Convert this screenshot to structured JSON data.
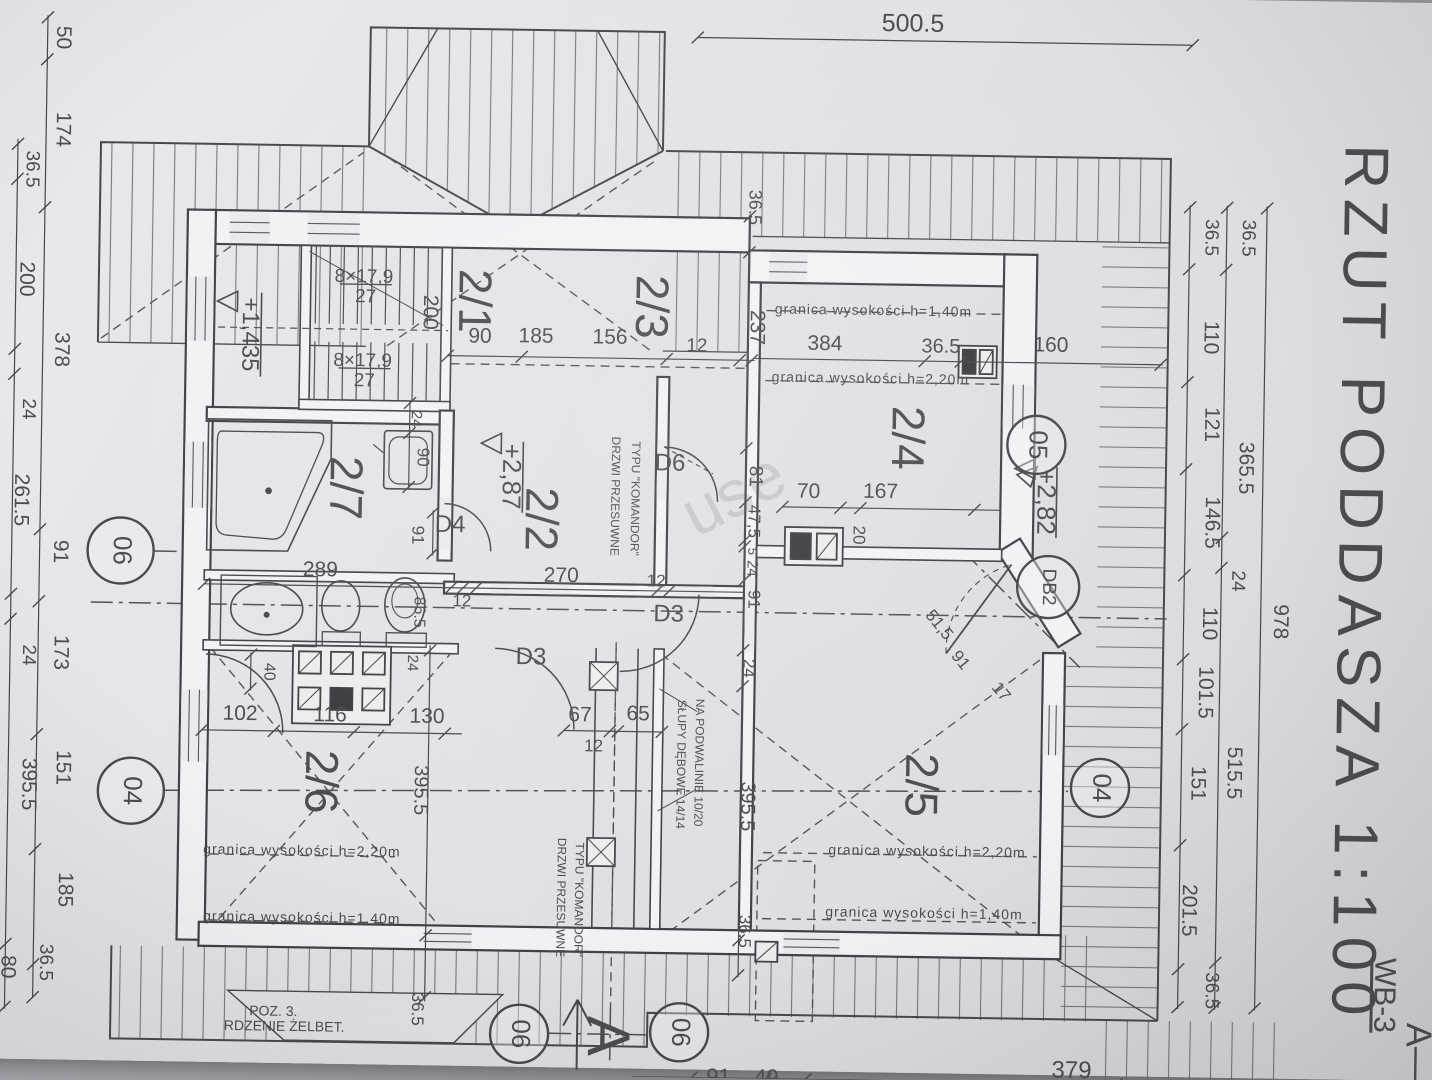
{
  "title_block": {
    "title": "RZUT PODDASZA 1:100",
    "drawing_code": "WB-3",
    "section_mark": "A—"
  },
  "rooms": [
    "2/1",
    "2/2",
    "2/3",
    "2/4",
    "2/5",
    "2/6",
    "2/7"
  ],
  "colors": {
    "paper": "#e2e3e7",
    "ink": "#47484d",
    "hatch": "#63646b",
    "backdrop": "#9a9ba1"
  },
  "watermark": {
    "t": "use",
    "x": 735,
    "y": 498,
    "r": -28,
    "s": 66,
    "o": 0.16,
    "c": "#7c828c"
  },
  "labels": [
    {
      "n": "sheet-title",
      "t": "RZUT PODDASZA 1:100",
      "x": 1356,
      "y": 575,
      "r": 90,
      "s": 62,
      "ls": 10,
      "c": "#85868d"
    },
    {
      "n": "drawing-code",
      "t": "WB-3",
      "x": 1390,
      "y": 985,
      "r": 90,
      "s": 30,
      "u": true
    },
    {
      "n": "section-letter",
      "t": "A—",
      "x": 1424,
      "y": 1042,
      "r": 90,
      "s": 36
    },
    {
      "n": "section-arrow-letter",
      "t": "A",
      "x": 612,
      "y": 1038,
      "r": 90,
      "s": 60
    },
    {
      "t": "500.5",
      "x": 905,
      "y": 22,
      "s": 25
    },
    {
      "t": "50",
      "x": 55,
      "y": 48,
      "r": 90
    },
    {
      "t": "174",
      "x": 56,
      "y": 140,
      "r": 90
    },
    {
      "t": "378",
      "x": 58,
      "y": 360,
      "r": 90
    },
    {
      "t": "91",
      "x": 60,
      "y": 562,
      "r": 90
    },
    {
      "t": "173",
      "x": 62,
      "y": 663,
      "r": 90
    },
    {
      "t": "151",
      "x": 66,
      "y": 778,
      "r": 90
    },
    {
      "t": "185",
      "x": 70,
      "y": 900,
      "r": 90
    },
    {
      "t": "36.5",
      "x": 52,
      "y": 973,
      "r": 90,
      "s": 19
    },
    {
      "t": "36.5",
      "x": 26,
      "y": 180,
      "r": 90,
      "s": 19
    },
    {
      "t": "200",
      "x": 22,
      "y": 290,
      "r": 90
    },
    {
      "t": "24",
      "x": 26,
      "y": 420,
      "r": 90,
      "s": 19
    },
    {
      "t": "261.5",
      "x": 20,
      "y": 511,
      "r": 90
    },
    {
      "t": "24",
      "x": 30,
      "y": 666,
      "r": 90,
      "s": 19
    },
    {
      "t": "395.5",
      "x": 32,
      "y": 795,
      "r": 90
    },
    {
      "t": "80",
      "x": 14,
      "y": 978,
      "r": 90
    },
    {
      "t": "36.5",
      "x": 1206,
      "y": 230,
      "r": 90,
      "s": 19
    },
    {
      "t": "110",
      "x": 1207,
      "y": 330,
      "r": 90
    },
    {
      "t": "121",
      "x": 1209,
      "y": 417,
      "r": 90
    },
    {
      "t": "146.5",
      "x": 1211,
      "y": 515,
      "r": 90
    },
    {
      "t": "110",
      "x": 1210,
      "y": 616,
      "r": 90
    },
    {
      "t": "101.5",
      "x": 1207,
      "y": 685,
      "r": 90
    },
    {
      "t": "151",
      "x": 1201,
      "y": 776,
      "r": 90
    },
    {
      "t": "201.5",
      "x": 1194,
      "y": 903,
      "r": 90
    },
    {
      "t": "36.5",
      "x": 1218,
      "y": 983,
      "r": 90,
      "s": 19
    },
    {
      "t": "36.5",
      "x": 1243,
      "y": 230,
      "r": 90,
      "s": 19
    },
    {
      "t": "365.5",
      "x": 1244,
      "y": 460,
      "r": 90
    },
    {
      "t": "24",
      "x": 1238,
      "y": 573,
      "r": 90,
      "s": 19
    },
    {
      "t": "515.5",
      "x": 1237,
      "y": 765,
      "r": 90
    },
    {
      "t": "978",
      "x": 1281,
      "y": 613,
      "r": 90
    },
    {
      "t": "379",
      "x": 1080,
      "y": 1066,
      "s": 24
    },
    {
      "t": "91",
      "x": 727,
      "y": 1078,
      "s": 22
    },
    {
      "t": "49",
      "x": 775,
      "y": 1078,
      "s": 22
    },
    {
      "n": "room-label",
      "t": "2/1",
      "x": 468,
      "y": 305,
      "r": 90,
      "s": 46
    },
    {
      "n": "room-label",
      "t": "2/3",
      "x": 645,
      "y": 308,
      "r": 90,
      "s": 46
    },
    {
      "n": "room-label",
      "t": "2/2",
      "x": 538,
      "y": 522,
      "r": 90,
      "s": 46
    },
    {
      "n": "room-label",
      "t": "2/4",
      "x": 903,
      "y": 435,
      "r": 90,
      "s": 46
    },
    {
      "n": "room-label",
      "t": "2/7",
      "x": 342,
      "y": 494,
      "r": 90,
      "s": 46
    },
    {
      "n": "room-label",
      "t": "2/6",
      "x": 322,
      "y": 788,
      "r": 90,
      "s": 46
    },
    {
      "n": "room-label",
      "t": "2/5",
      "x": 922,
      "y": 782,
      "r": 90,
      "s": 46
    },
    {
      "n": "stair-note",
      "t": "8×17,9",
      "x": 360,
      "y": 283,
      "s": 19
    },
    {
      "n": "stair-note",
      "t": "27",
      "x": 362,
      "y": 303,
      "s": 19
    },
    {
      "n": "stair-note",
      "t": "8×17,9",
      "x": 360,
      "y": 367,
      "s": 19
    },
    {
      "n": "stair-note",
      "t": "27",
      "x": 362,
      "y": 387,
      "s": 19
    },
    {
      "n": "level-mark",
      "t": "+1,435",
      "x": 246,
      "y": 342,
      "r": 90,
      "s": 24
    },
    {
      "n": "level-mark",
      "t": "+2,87",
      "x": 509,
      "y": 480,
      "r": 90,
      "s": 26
    },
    {
      "n": "level-mark",
      "t": "+2,82",
      "x": 1044,
      "y": 497,
      "r": 90,
      "s": 26
    },
    {
      "t": "200",
      "x": 426,
      "y": 317,
      "r": 90
    },
    {
      "t": "90",
      "x": 477,
      "y": 341
    },
    {
      "t": "185",
      "x": 533,
      "y": 340
    },
    {
      "t": "156",
      "x": 607,
      "y": 340
    },
    {
      "t": "12",
      "x": 694,
      "y": 347,
      "s": 19
    },
    {
      "t": "384",
      "x": 822,
      "y": 343
    },
    {
      "t": "36.5",
      "x": 938,
      "y": 344,
      "s": 20
    },
    {
      "t": "160",
      "x": 1048,
      "y": 341
    },
    {
      "t": "237",
      "x": 753,
      "y": 327,
      "r": 90,
      "s": 21
    },
    {
      "t": "36.5",
      "x": 749,
      "y": 207,
      "r": 90,
      "s": 18
    },
    {
      "n": "height-limit",
      "t": "granica wysokości h=1,40m",
      "x": 870,
      "y": 309,
      "s": 14,
      "ls": 1
    },
    {
      "n": "height-limit",
      "t": "granica wysokości h=2,20m",
      "x": 868,
      "y": 377,
      "s": 14,
      "ls": 1
    },
    {
      "t": "70",
      "x": 808,
      "y": 491,
      "s": 21
    },
    {
      "t": "20",
      "x": 858,
      "y": 533,
      "r": 90,
      "s": 17
    },
    {
      "t": "167",
      "x": 880,
      "y": 490,
      "s": 21
    },
    {
      "t": "81",
      "x": 754,
      "y": 476,
      "r": 90,
      "s": 19
    },
    {
      "t": "47,5",
      "x": 753,
      "y": 521,
      "r": 90,
      "s": 17
    },
    {
      "t": "5",
      "x": 752,
      "y": 551,
      "r": 90,
      "s": 13
    },
    {
      "t": "24",
      "x": 752,
      "y": 568,
      "r": 90,
      "s": 15
    },
    {
      "t": "91",
      "x": 754,
      "y": 599,
      "r": 90,
      "s": 17
    },
    {
      "t": "24",
      "x": 750,
      "y": 668,
      "r": 90,
      "s": 17
    },
    {
      "t": "395.5",
      "x": 751,
      "y": 806,
      "r": 90,
      "s": 20
    },
    {
      "t": "36.5",
      "x": 750,
      "y": 931,
      "r": 90,
      "s": 17
    },
    {
      "n": "door-label",
      "t": "D6",
      "x": 669,
      "y": 465,
      "s": 24
    },
    {
      "n": "door-note",
      "t": "DRZWI PRZESUWNE",
      "x": 614,
      "y": 498,
      "r": 90,
      "s": 12
    },
    {
      "n": "door-note",
      "t": "TYPU \"KOMANDOR\"",
      "x": 634,
      "y": 500,
      "r": 90,
      "s": 12
    },
    {
      "n": "door-label",
      "t": "D3",
      "x": 670,
      "y": 616,
      "s": 24
    },
    {
      "n": "door-label",
      "t": "D3",
      "x": 533,
      "y": 661,
      "s": 24
    },
    {
      "n": "door-label",
      "t": "D4",
      "x": 450,
      "y": 530,
      "s": 24
    },
    {
      "t": "270",
      "x": 562,
      "y": 579,
      "s": 21
    },
    {
      "t": "12",
      "x": 657,
      "y": 583,
      "s": 17
    },
    {
      "t": "12",
      "x": 463,
      "y": 606,
      "s": 17
    },
    {
      "t": "86.5",
      "x": 420,
      "y": 617,
      "r": 90,
      "s": 16
    },
    {
      "t": "289",
      "x": 321,
      "y": 577,
      "s": 21
    },
    {
      "t": "40",
      "x": 271,
      "y": 679,
      "r": 90,
      "s": 16
    },
    {
      "t": "24",
      "x": 414,
      "y": 668,
      "r": 90,
      "s": 15
    },
    {
      "t": "102",
      "x": 243,
      "y": 722,
      "s": 21
    },
    {
      "t": "116",
      "x": 333,
      "y": 722,
      "s": 21
    },
    {
      "t": "130",
      "x": 430,
      "y": 722,
      "s": 21
    },
    {
      "t": "91",
      "x": 417,
      "y": 540,
      "r": 90,
      "s": 17
    },
    {
      "t": "24",
      "x": 414,
      "y": 424,
      "r": 90,
      "s": 15
    },
    {
      "t": "90",
      "x": 421,
      "y": 462,
      "r": 90,
      "s": 17
    },
    {
      "t": "65",
      "x": 641,
      "y": 716,
      "s": 21
    },
    {
      "t": "67",
      "x": 583,
      "y": 718,
      "s": 21
    },
    {
      "t": "12",
      "x": 597,
      "y": 749,
      "s": 17
    },
    {
      "n": "post-note",
      "t": "SŁUPY DĘBOWE 14/14",
      "x": 684,
      "y": 765,
      "r": 90,
      "s": 12
    },
    {
      "n": "post-note",
      "t": "NA PODWALINIE 10/20",
      "x": 702,
      "y": 763,
      "r": 90,
      "s": 12
    },
    {
      "n": "door-note",
      "t": "DRZWI PRZESUWNE",
      "x": 566,
      "y": 900,
      "r": 90,
      "s": 12
    },
    {
      "n": "door-note",
      "t": "TYPU \"KOMANDOR\"",
      "x": 584,
      "y": 902,
      "r": 90,
      "s": 12
    },
    {
      "n": "height-limit",
      "t": "granica wysokości h=2,20m",
      "x": 307,
      "y": 858,
      "s": 14,
      "ls": 1
    },
    {
      "n": "height-limit",
      "t": "granica wysokości h=1,40m",
      "x": 308,
      "y": 925,
      "s": 14,
      "ls": 1
    },
    {
      "n": "height-limit",
      "t": "granica wysokości h=2,20m",
      "x": 932,
      "y": 849,
      "s": 14,
      "ls": 1
    },
    {
      "n": "height-limit",
      "t": "granica wysokości h=1,40m",
      "x": 930,
      "y": 911,
      "s": 14,
      "ls": 1
    },
    {
      "n": "core-note",
      "t": "POZ. 3.",
      "x": 281,
      "y": 1019,
      "s": 14
    },
    {
      "n": "core-note",
      "t": "RDZENIE ŻELBET.",
      "x": 292,
      "y": 1034,
      "s": 14
    },
    {
      "t": "51,5",
      "x": 940,
      "y": 622,
      "r": 50,
      "s": 17
    },
    {
      "t": "91",
      "x": 962,
      "y": 657,
      "r": 50,
      "s": 17
    },
    {
      "t": "17",
      "x": 1003,
      "y": 688,
      "r": 50,
      "s": 17
    },
    {
      "t": "395.5",
      "x": 424,
      "y": 795,
      "r": 90,
      "s": 20
    },
    {
      "t": "36.5",
      "x": 424,
      "y": 1014,
      "r": 90,
      "s": 17
    }
  ],
  "section_marks": [
    {
      "t": "06",
      "x": 121,
      "y": 560,
      "r": 33
    },
    {
      "t": "04",
      "x": 135,
      "y": 800,
      "r": 33
    },
    {
      "t": "05",
      "x": 1035,
      "y": 440,
      "r": 29
    },
    {
      "t": "DB2",
      "x": 1049,
      "y": 582,
      "r": 31
    },
    {
      "t": "04",
      "x": 1104,
      "y": 782,
      "r": 29
    },
    {
      "t": "06",
      "x": 527,
      "y": 1037,
      "r": 29
    },
    {
      "t": "06",
      "x": 687,
      "y": 1033,
      "r": 29
    }
  ],
  "dim_chains": [
    {
      "o": "h",
      "pos": 38,
      "from": 690,
      "to": 1185,
      "ticks": [
        690,
        1185
      ]
    },
    {
      "o": "v",
      "pos": 40,
      "from": 26,
      "to": 1008,
      "ticks": [
        28,
        70,
        218,
        540,
        612,
        745,
        860,
        975,
        1008
      ]
    },
    {
      "o": "v",
      "pos": 12,
      "from": 150,
      "to": 1020,
      "ticks": [
        155,
        190,
        360,
        385,
        605,
        630,
        955,
        1018
      ]
    },
    {
      "o": "v",
      "pos": 1185,
      "from": 198,
      "to": 1002,
      "ticks": [
        200,
        262,
        375,
        462,
        568,
        652,
        722,
        838,
        962,
        1000
      ]
    },
    {
      "o": "v",
      "pos": 1222,
      "from": 198,
      "to": 1002,
      "ticks": [
        200,
        262,
        530,
        560,
        955,
        1000
      ]
    },
    {
      "o": "v",
      "pos": 1262,
      "from": 198,
      "to": 1002,
      "ticks": [
        200,
        1000
      ]
    },
    {
      "o": "h",
      "pos": 1078,
      "from": 640,
      "to": 1310,
      "ticks": [
        700,
        774,
        814,
        1125
      ]
    },
    {
      "o": "h",
      "pos": 360,
      "from": 445,
      "to": 752,
      "ticks": [
        445,
        519,
        664,
        737,
        749
      ]
    },
    {
      "o": "h",
      "pos": 358,
      "from": 752,
      "to": 1160,
      "ticks": [
        922,
        958,
        1158
      ]
    },
    {
      "o": "v",
      "pos": 745,
      "from": 214,
      "to": 977,
      "ticks": [
        216,
        252,
        448,
        502,
        540,
        546,
        580,
        650,
        686,
        940,
        975
      ]
    },
    {
      "o": "h",
      "pos": 592,
      "from": 205,
      "to": 745,
      "ticks": [
        205,
        452,
        464,
        477,
        658,
        670
      ]
    },
    {
      "o": "h",
      "pos": 738,
      "from": 205,
      "to": 465,
      "ticks": [
        205,
        277,
        357,
        448
      ]
    },
    {
      "o": "h",
      "pos": 506,
      "from": 782,
      "to": 1000,
      "ticks": [
        782,
        840,
        860,
        974
      ]
    },
    {
      "o": "v",
      "pos": 408,
      "from": 406,
      "to": 494,
      "ticks": [
        408,
        438,
        492
      ]
    },
    {
      "o": "v",
      "pos": 433,
      "from": 515,
      "to": 560,
      "ticks": [
        517,
        558
      ]
    },
    {
      "o": "v",
      "pos": 253,
      "from": 660,
      "to": 698,
      "ticks": [
        662,
        696
      ]
    },
    {
      "o": "h",
      "pos": 733,
      "from": 567,
      "to": 665,
      "ticks": [
        567,
        613,
        621,
        665
      ]
    },
    {
      "o": "v",
      "pos": 432,
      "from": 650,
      "to": 1006,
      "ticks": [
        655,
        940,
        1002
      ]
    }
  ]
}
